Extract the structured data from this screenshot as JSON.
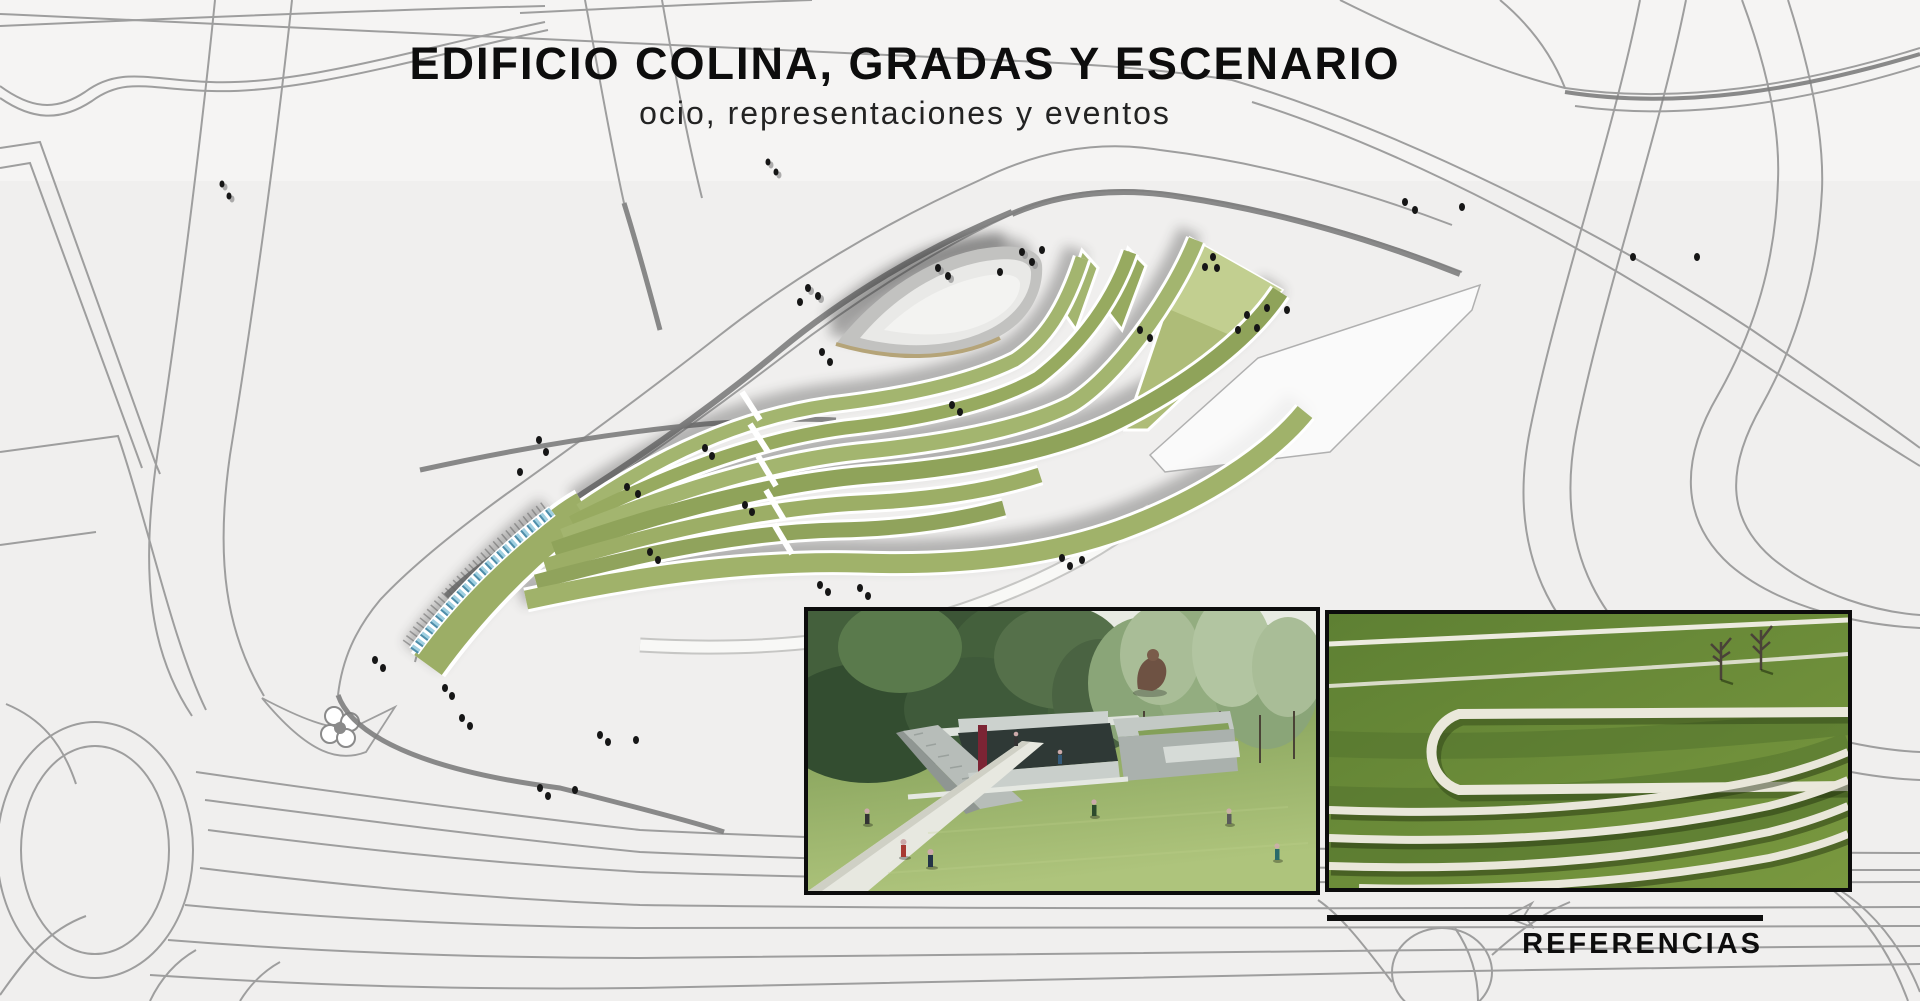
{
  "header": {
    "title": "EDIFICIO COLINA, GRADAS Y ESCENARIO",
    "subtitle": "ocio, representaciones y eventos"
  },
  "references": {
    "label": "REFERENCIAS"
  },
  "photos": {
    "photo1_alt": "Render of park with sunken concrete courtyard building in a lawn surrounded by trees",
    "photo2_alt": "Aerial photo of grass terraces edged with white concrete bands"
  },
  "palette": {
    "background": "#f0efee",
    "background_top": "#f5f4f3",
    "road_line": "#9e9e9e",
    "road_dark": "#7d7d7d",
    "terrace_green": "#9cae66",
    "stage_gray": "#e9e9e7",
    "water_blue": "#9fcfe0",
    "text_black": "#0d0d0d"
  }
}
